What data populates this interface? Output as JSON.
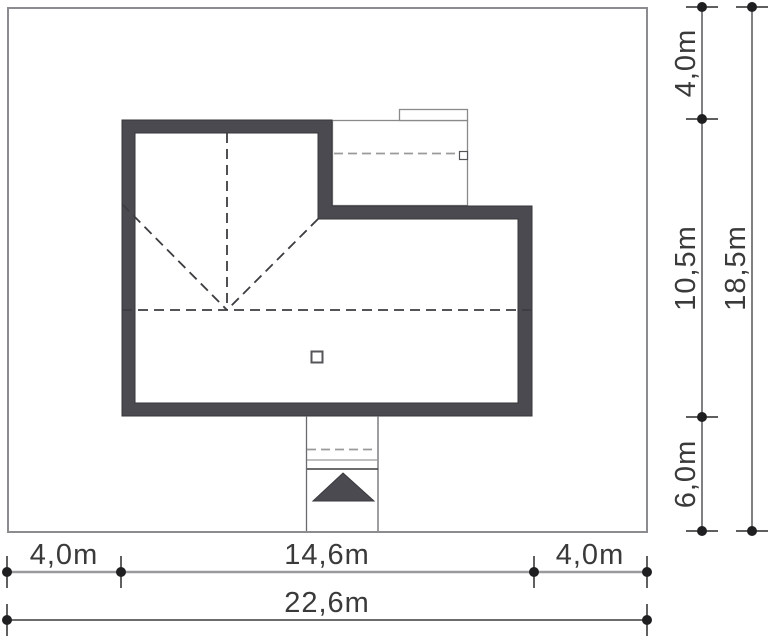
{
  "drawing": {
    "type": "architectural-site-plan",
    "elements": {
      "plot_boundary": "plot boundary",
      "house_walls": "house outline",
      "garage_outline": "garage roof outline",
      "roof_lines": "roof ridge and hip lines",
      "chimney": "chimney",
      "entrance_path": "entrance path",
      "entrance_arrow": "entrance arrow"
    }
  },
  "dimensions": {
    "bottom": {
      "segments": [
        {
          "label": "4,0m"
        },
        {
          "label": "14,6m"
        },
        {
          "label": "4,0m"
        }
      ],
      "total": "22,6m"
    },
    "right": {
      "segments": [
        {
          "label": "4,0m"
        },
        {
          "label": "10,5m"
        },
        {
          "label": "6,0m"
        }
      ],
      "total": "18,5m"
    }
  },
  "colors": {
    "wall": "#4a4a50",
    "boundary": "#8b8b90",
    "dimension_gray": "#9a9a9e",
    "dimension_dark": "#3b3b3b",
    "text": "#3a3a3a"
  }
}
